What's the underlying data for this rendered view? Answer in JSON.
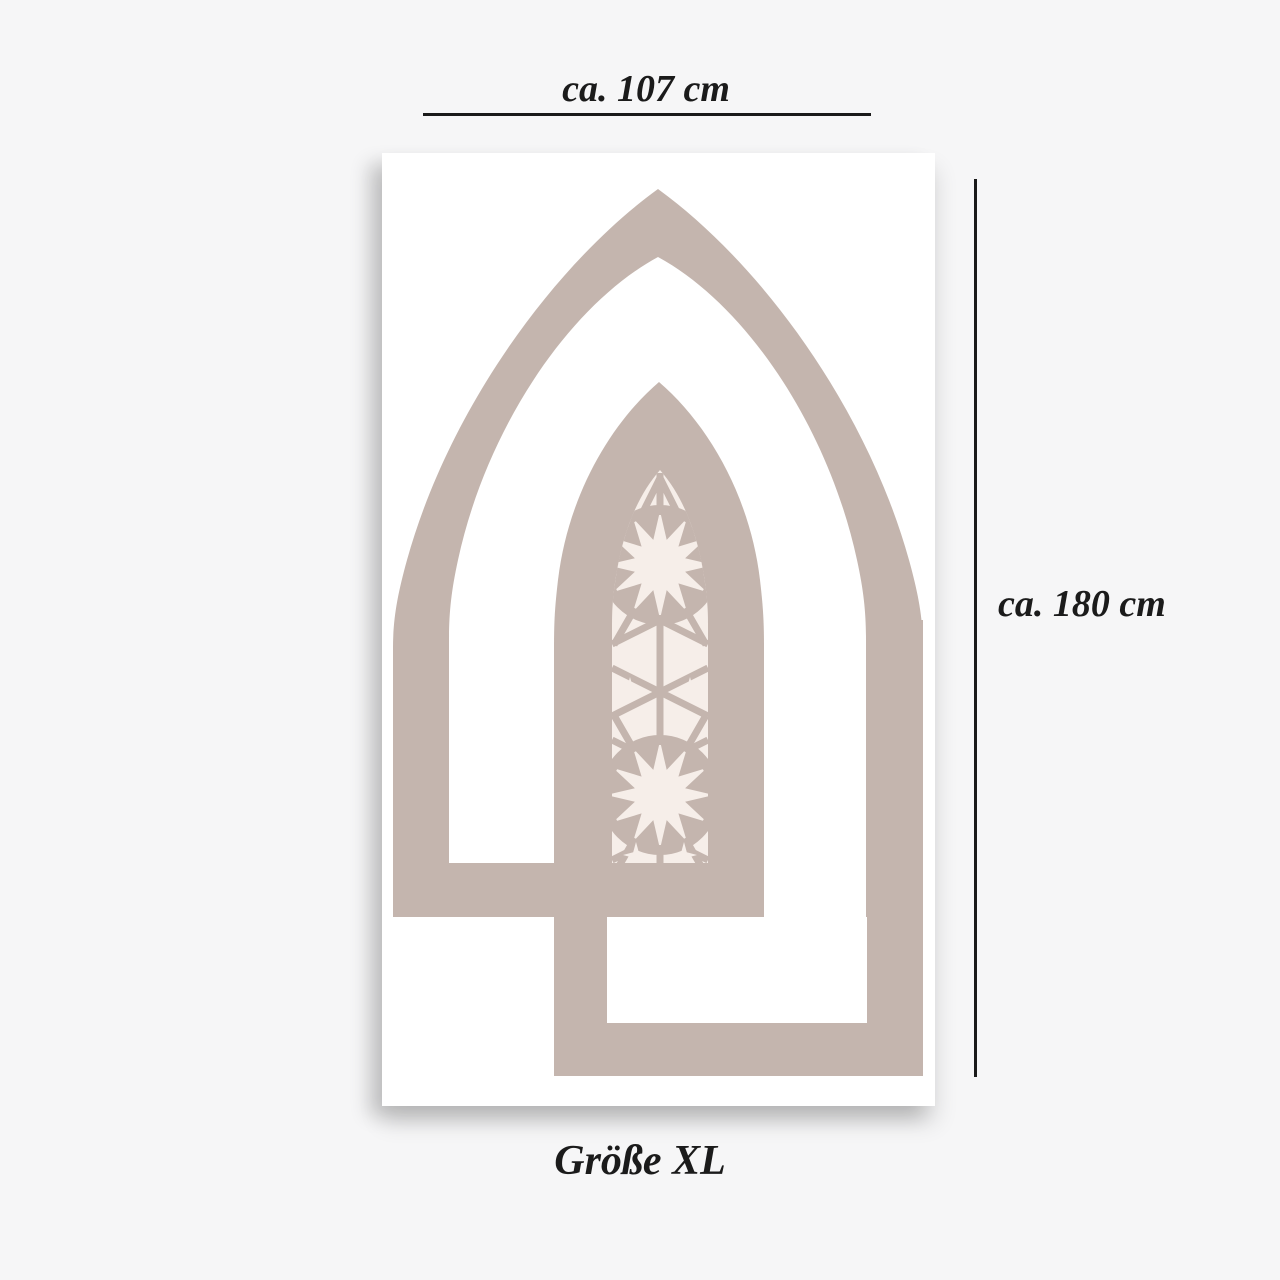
{
  "page": {
    "background_color": "#f6f6f7"
  },
  "canvas": {
    "color": "#ffffff"
  },
  "artwork": {
    "arch_color": "#c4b5ae",
    "ornament_background_color": "#f6eee9",
    "motif_names": [
      "outer-pointed-arch",
      "inner-pointed-arch",
      "ornament-window",
      "star-rosette",
      "sparkle-stars"
    ]
  },
  "annotations": {
    "width_label": "ca. 107 cm",
    "height_label": "ca. 180 cm",
    "size_label": "Größe XL",
    "line_color": "#1a1a1a"
  }
}
